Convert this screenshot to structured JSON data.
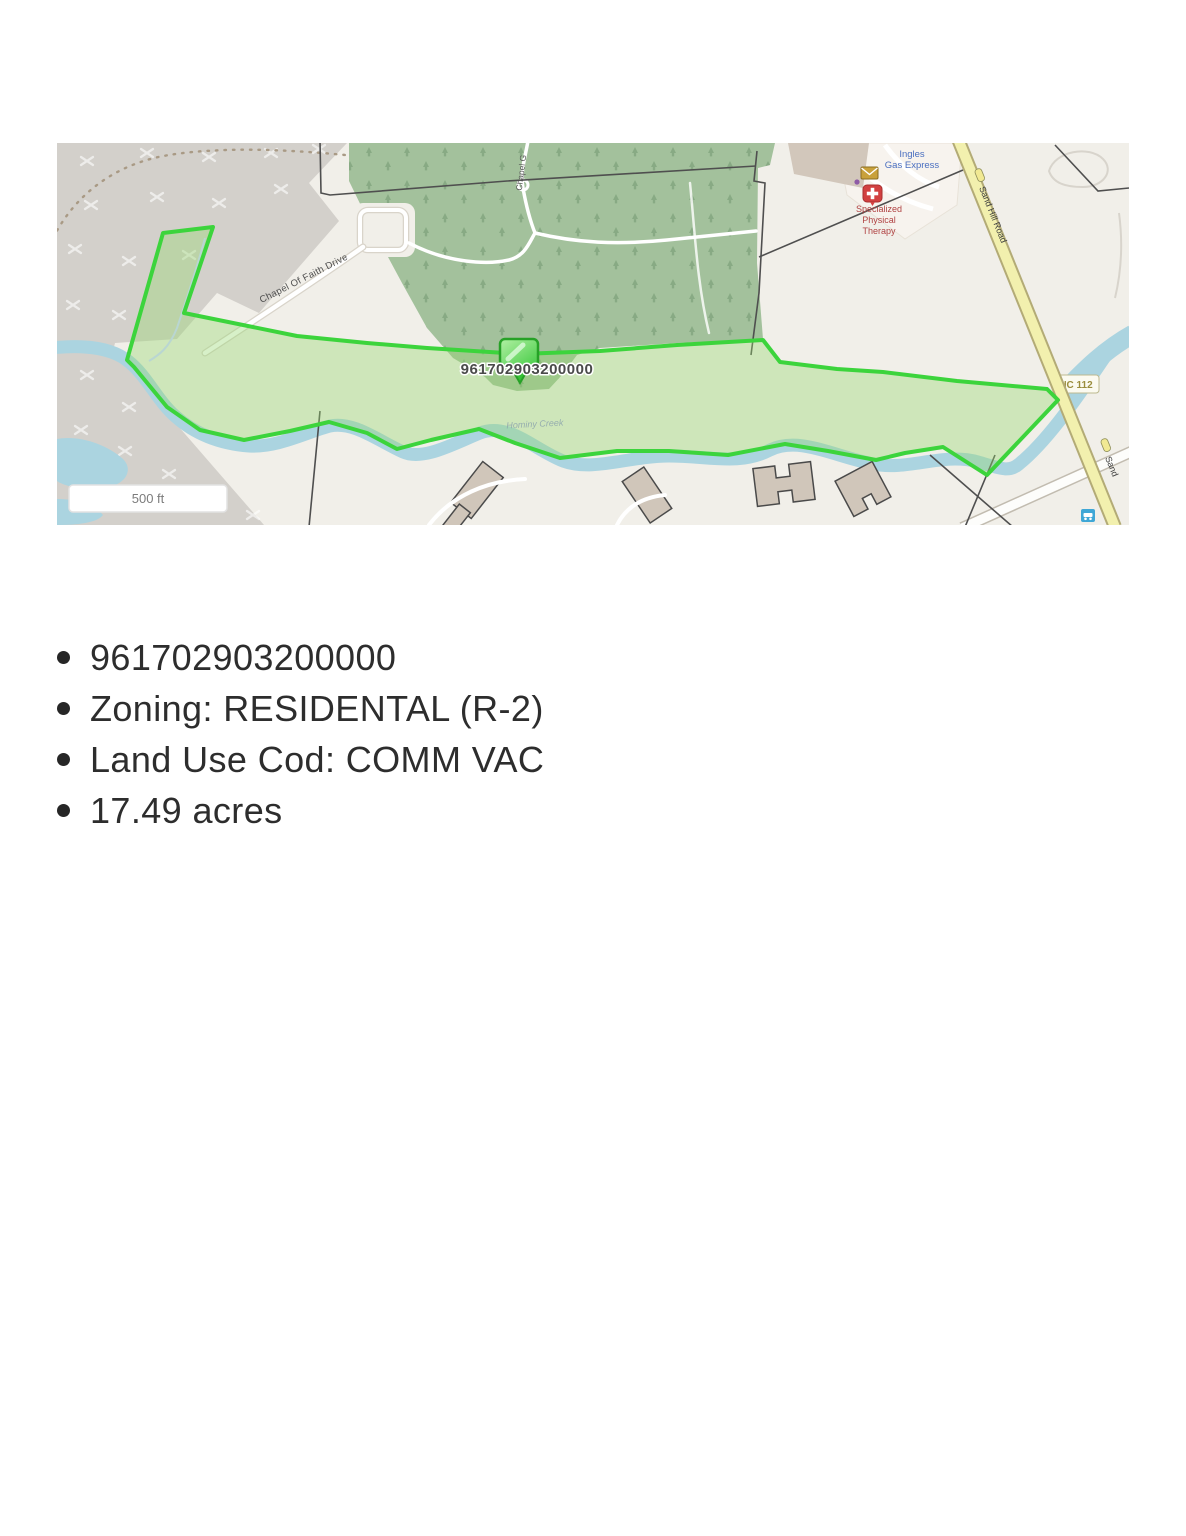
{
  "map": {
    "parcel_marker_label": "961702903200000",
    "scale_bar_label": "500 ft",
    "roads": {
      "chapel_of_faith": "Chapel Of Faith Drive",
      "chapel_vertical": "Chapel G",
      "sand_hill": "Sand Hill Road",
      "sand_hill_truncated": "Sand",
      "route_shield": "NC 112"
    },
    "pois": {
      "gas": {
        "line1": "Ingles",
        "line2": "Gas Express"
      },
      "therapy": {
        "line1": "Specialized",
        "line2": "Physical",
        "line3": "Therapy"
      }
    },
    "water": {
      "stream_label": "Hominy Creek"
    },
    "colors": {
      "parcel_outline": "#3cd43c",
      "parcel_fill": "#d9eec9",
      "forest": "#a3c19c",
      "quarry": "#d3d0cb",
      "water": "#abd4e0",
      "road_yellow": "#f2f0ae",
      "base": "#f1efe9"
    }
  },
  "details": {
    "items": [
      "961702903200000",
      "Zoning: RESIDENTAL (R-2)",
      "Land Use Cod: COMM VAC",
      "17.49 acres"
    ]
  }
}
